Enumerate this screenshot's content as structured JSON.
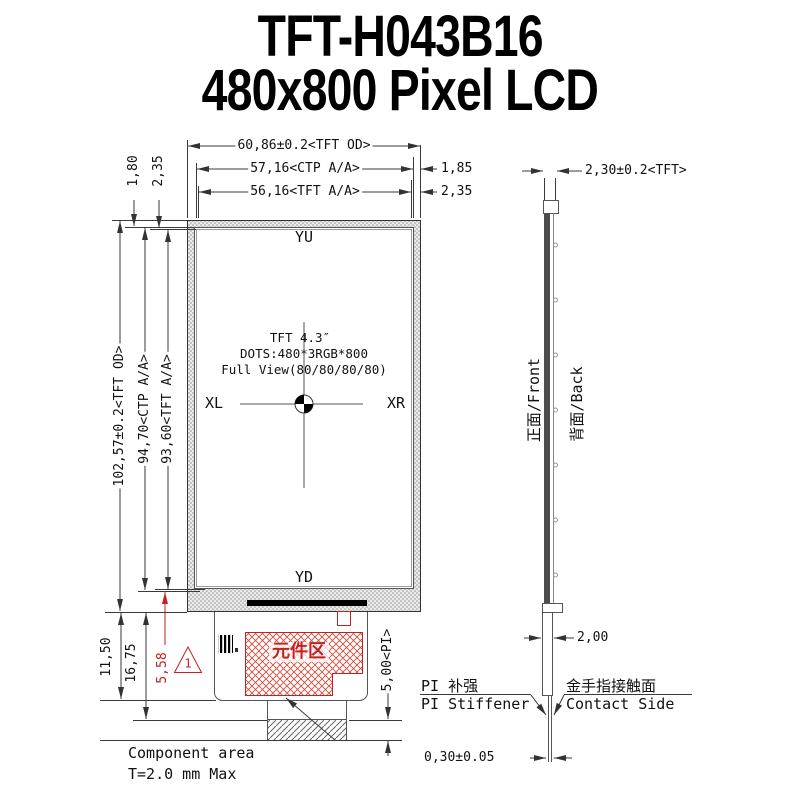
{
  "title": {
    "line1": "TFT-H043B16",
    "line2": "480x800 Pixel LCD"
  },
  "front_view": {
    "dim_width_od": "60,86±0.2<TFT OD>",
    "dim_width_ctp": "57,16<CTP A/A>",
    "dim_width_tft": "56,16<TFT A/A>",
    "dim_gap_right_ctp": "1,85",
    "dim_gap_right_tft": "2,35",
    "dim_gap_top_ctp": "1,80",
    "dim_gap_top_tft": "2,35",
    "dim_height_od": "102,57±0.2<TFT OD>",
    "dim_height_ctp": "94,70<CTP A/A>",
    "dim_height_tft": "93,60<TFT A/A>",
    "label_yu": "YU",
    "label_yd": "YD",
    "label_xl": "XL",
    "label_xr": "XR",
    "center_line1": "TFT 4.3″",
    "center_line2": "DOTS:480*3RGB*800",
    "center_line3": "Full View(80/80/80/80)",
    "dim_bottom_1": "11,50",
    "dim_bottom_2": "16,75",
    "dim_bottom_red": "5,58",
    "triangle_mark": "1",
    "component_area_cn": "元件区",
    "dim_pi": "5,00<PI>",
    "note_component_1": "Component area",
    "note_component_2": "T=2.0 mm Max"
  },
  "side_view": {
    "dim_thickness": "2,30±0.2<TFT>",
    "label_front": "正面/Front",
    "label_back": "背面/Back",
    "dim_tail": "2,00",
    "stiffener_cn": "PI 补强",
    "stiffener_en": "PI Stiffener",
    "contact_cn": "金手指接触面",
    "contact_en": "Contact Side",
    "dim_fpc_thickness": "0,30±0.05"
  },
  "colors": {
    "accent_red": "#c32222",
    "line": "#3a3a3a",
    "hatch_gray": "#9a9a9a"
  }
}
